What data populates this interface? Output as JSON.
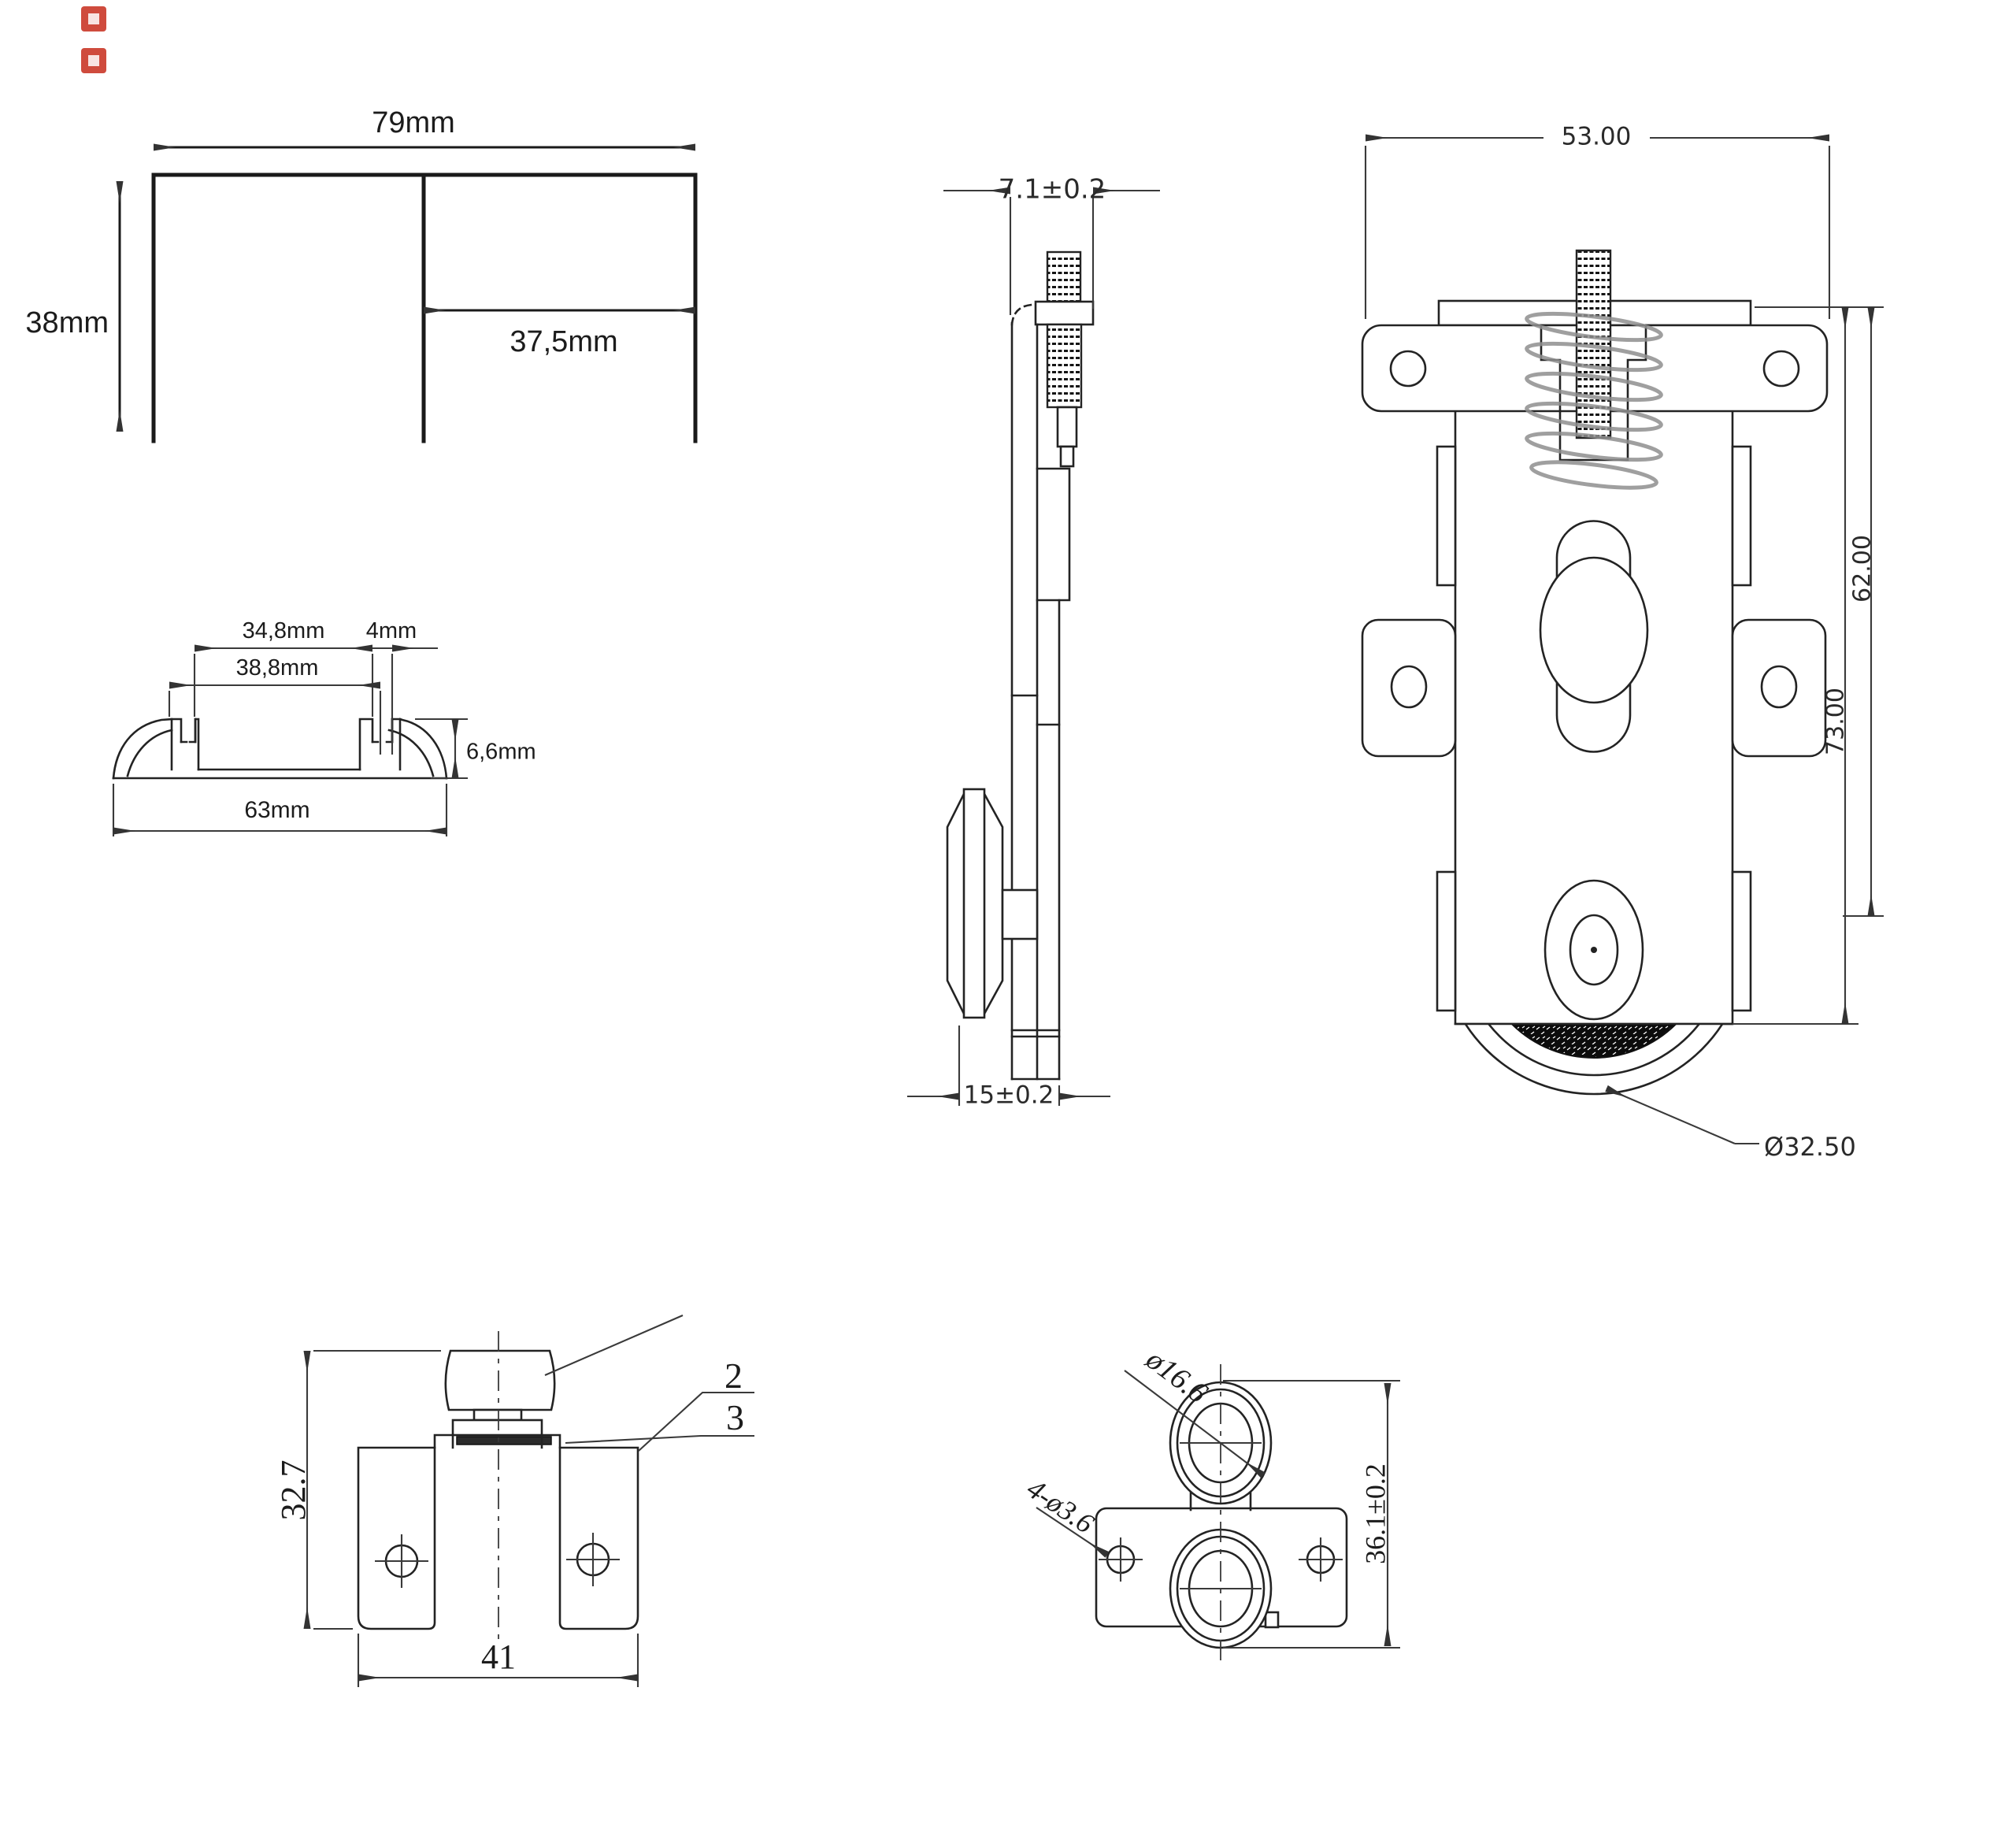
{
  "meta": {
    "background": "#ffffff",
    "line_color": "#232323",
    "dim_color": "#3a3a3a",
    "glitch_color": "#cf4b3d"
  },
  "figures": {
    "channel_top": {
      "width": "79mm",
      "height": "38mm",
      "inner_width": "37,5mm"
    },
    "track_profile": {
      "slot_span": "34,8mm",
      "slot_width": "4mm",
      "inner_span": "38,8mm",
      "height": "6,6mm",
      "total_width": "63mm"
    },
    "roller_side": {
      "head_width": "7.1±0.2",
      "body_width": "15±0.2"
    },
    "roller_front": {
      "plate_width": "53.00",
      "height_upper": "62.00",
      "height_total": "73.00",
      "wheel_diameter": "Ø32.50"
    },
    "lower_bracket": {
      "height": "32.7",
      "width": "41",
      "callout_washer_top": "2",
      "callout_washer_bottom": "3"
    },
    "roller_guide": {
      "roller_diameter": "ø16.6",
      "hole_spec": "4-ø3.6",
      "height": "36.1±0.2"
    }
  }
}
